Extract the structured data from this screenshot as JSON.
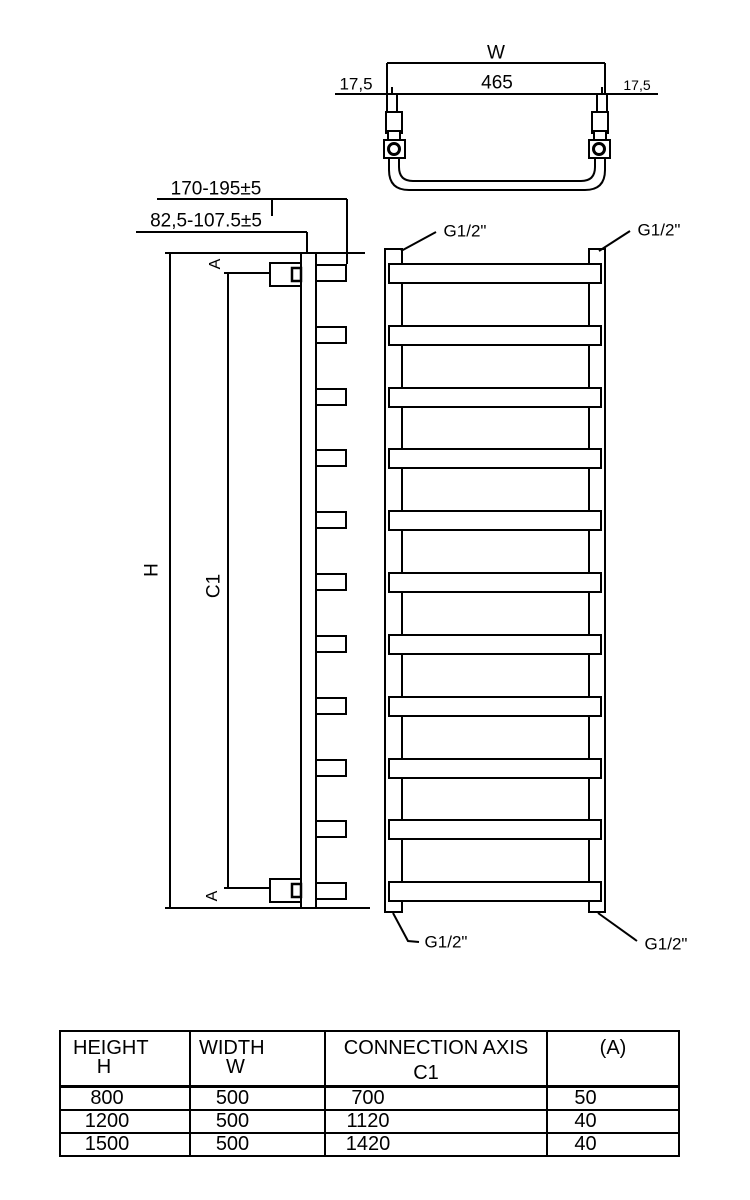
{
  "drawing": {
    "top_view": {
      "width_label": "W",
      "inner_span": "465",
      "offset_left": "17,5",
      "offset_right": "17,5"
    },
    "side_view": {
      "depth_range_outer": "170-195±5",
      "depth_range_axis": "82,5-107.5±5",
      "height_label": "H",
      "connection_axis_label": "C1",
      "section_marker": "A"
    },
    "front_view": {
      "thread_label": "G1/2\""
    }
  },
  "table": {
    "headers": [
      {
        "line1": "HEIGHT",
        "line2": "H"
      },
      {
        "line1": "WIDTH",
        "line2": "W"
      },
      {
        "line1": "CONNECTION AXIS",
        "line2": "C1"
      },
      {
        "line1": "(A)",
        "line2": ""
      }
    ],
    "rows": [
      [
        "800",
        "500",
        "700",
        "50"
      ],
      [
        "1200",
        "500",
        "1120",
        "40"
      ],
      [
        "1500",
        "500",
        "1420",
        "40"
      ]
    ]
  },
  "colors": {
    "line": "#000000",
    "background": "#ffffff"
  }
}
